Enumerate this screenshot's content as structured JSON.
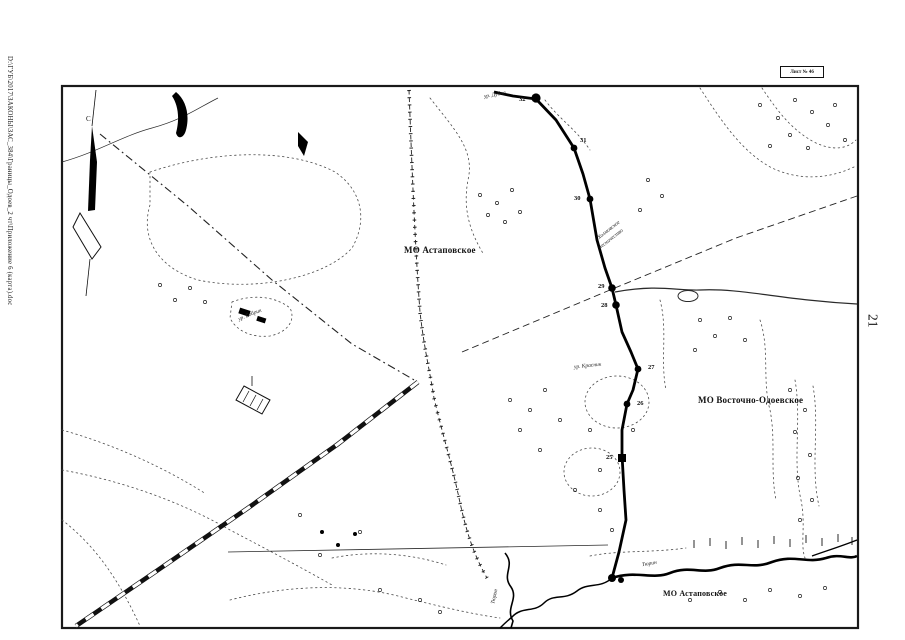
{
  "page": {
    "file_path": "D:\\ГУБ\\2017\\ЗАКОНЫ\\ЗАС_384\\Границы_Одоев_2 чт\\Приложение 6 (карта).doc",
    "page_number": "21",
    "sheet_label": "Лист № 46"
  },
  "map": {
    "municipalities": [
      {
        "label": "МО Астаповское"
      },
      {
        "label": "МО Восточно-Одоевское"
      },
      {
        "label": "МО Астаповское"
      }
    ],
    "features": {
      "dubna": "ур. Дубна",
      "forest_line1": "Холмовское",
      "forest_line2": "лесничество",
      "krasnik": "ур. Красник",
      "tyurin_east": "Тюрин",
      "tyurin_south": "Тюрин",
      "bobrik": "ур. Бобрик",
      "north_mark": "С"
    },
    "boundary_points": [
      "32",
      "31",
      "30",
      "29",
      "28",
      "27",
      "26",
      "25"
    ]
  }
}
